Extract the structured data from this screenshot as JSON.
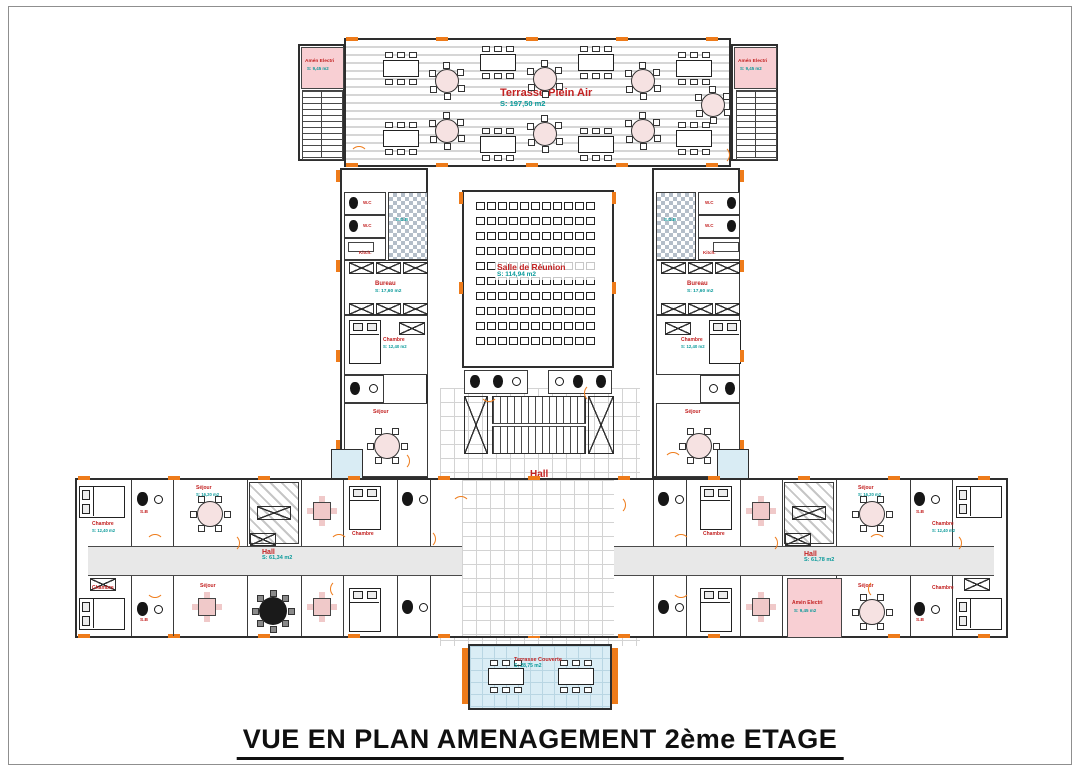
{
  "title": "VUE EN PLAN AMENAGEMENT 2ème ETAGE",
  "colors": {
    "accent_orange": "#ee7b1a",
    "room_label_red": "#c32222",
    "area_label_teal": "#0a9a9a",
    "wall": "#2e2e2e",
    "pink_room": "#f8cfd3",
    "blue_room": "#d9ecf4"
  },
  "labels": {
    "terrace": {
      "name": "Terrasse Plein Air",
      "area": "S: 197,50 m2"
    },
    "meeting": {
      "name": "Salle de Réunion",
      "area": "S: 114,94 m2"
    },
    "hall_center": {
      "name": "Hall",
      "area": "S: 238,38 m2"
    },
    "hall_left": {
      "name": "Hall",
      "area": "S: 61,34 m2"
    },
    "hall_right": {
      "name": "Hall",
      "area": "S: 61,78 m2"
    },
    "bottom_room": {
      "name": "Terrasse Couverte",
      "area": "S: 28,75 m2"
    },
    "elec": {
      "name": "Amén Electri",
      "area": "S: 9,45 m2"
    },
    "bureau": {
      "name": "Bureau",
      "area": "S: 17,60 m2"
    },
    "chambre": {
      "name": "Chambre",
      "area": "S: 12,40 m2"
    },
    "sejour": {
      "name": "Séjour",
      "area": "S: 16,20 m2"
    },
    "sdb": {
      "name": "S.D.B"
    },
    "sb": {
      "name": "S.B"
    },
    "wc": {
      "name": "W.C"
    },
    "kitch": {
      "name": "Kitch."
    }
  },
  "meeting_seats": {
    "rows": 10,
    "cols": 11
  }
}
